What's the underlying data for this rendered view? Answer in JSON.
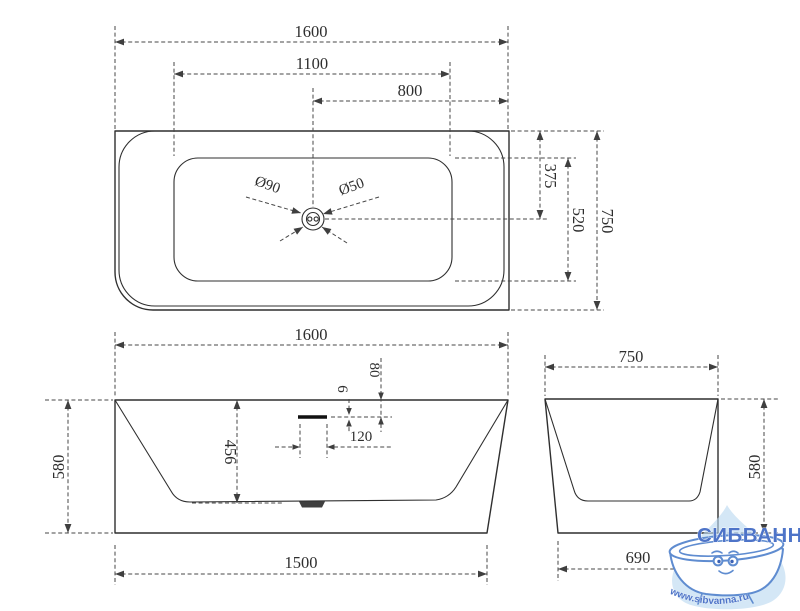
{
  "top_view": {
    "length_overall": "1600",
    "length_basin": "1100",
    "drain_to_right_edge": "800",
    "top_edge_to_drain": "375",
    "width_basin": "520",
    "width_overall": "750",
    "drain_hole": "Ø90",
    "waste_hole": "Ø50"
  },
  "front_view": {
    "length_overall": "1600",
    "height_overall": "580",
    "depth_inner": "456",
    "overflow_height": "6",
    "overflow_from_rim": "80",
    "overflow_length": "120",
    "length_base": "1500"
  },
  "side_view": {
    "width_overall": "750",
    "height_overall": "580",
    "width_base": "690"
  },
  "watermark": {
    "brand": "СИБВАННА",
    "website": "www.sibvanna.ru"
  },
  "colors": {
    "line": "#2f2f2f",
    "dimension": "#474747",
    "watermark_blue": "#4e74c8",
    "drop_blue": "#b9d8f1"
  }
}
